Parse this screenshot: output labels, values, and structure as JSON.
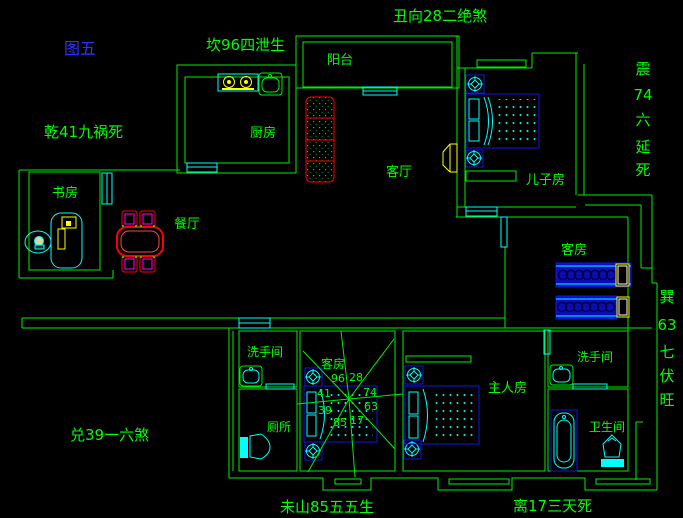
{
  "figure": {
    "title": "图五"
  },
  "annotations": {
    "top_center": "丑向28二绝煞",
    "north": "坎96四泄生",
    "northwest": "乾41九祸死",
    "west": "兑39一六煞",
    "south_left": "未山85五五生",
    "south_right": "离17三天死",
    "east_vertical": [
      "震",
      "74",
      "六",
      "延",
      "死"
    ],
    "southeast_vertical": [
      "巽",
      "63",
      "七",
      "伏",
      "旺"
    ]
  },
  "rooms": {
    "balcony": "阳台",
    "kitchen": "厨房",
    "living": "客厅",
    "dining": "餐厅",
    "study": "书房",
    "son_room": "儿子房",
    "guest_right": "客房",
    "guest_center": "客房",
    "master": "主人房",
    "wash_left": "洗手间",
    "wash_right": "洗手间",
    "wc": "厕所",
    "bath": "卫生间"
  },
  "compass": {
    "numbers": [
      "96",
      "28",
      "41",
      "74",
      "39",
      "63",
      "85",
      "17"
    ]
  },
  "colors": {
    "background": "#000000",
    "wall_green": "#00ee00",
    "label_green": "#00ff00",
    "title_blue": "#3232ff",
    "window_door_cyan": "#00ffff",
    "furniture_blue": "#1515ee",
    "sofa_table_red": "#ff0000",
    "chair_magenta": "#ff00ff",
    "appliance_yellow": "#ffff00"
  }
}
